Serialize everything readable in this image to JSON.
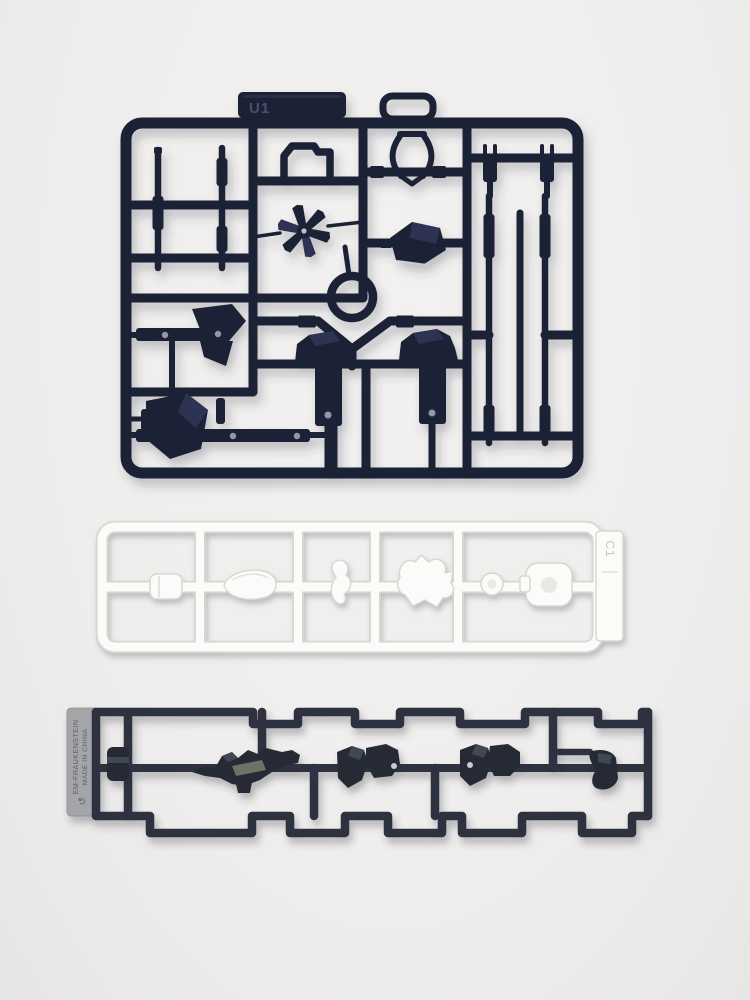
{
  "colors": {
    "background": "#f2f1f0",
    "sprue_black": "#1d2034",
    "sprue_black_facet": "#2e3252",
    "dot_light": "#a7adc0",
    "emboss_navy": "#4a4f72",
    "sprue_white": "#fbfbf9",
    "sprue_white_edge": "#d7d6d1",
    "sprue_white_hole": "#e9e8e4",
    "white_tab_text": "#c8c7c2",
    "sprue_charcoal": "#2e3240",
    "charcoal_part": "#262a36",
    "charcoal_facet": "#424757",
    "charcoal_panel": "#6d7268",
    "tab_gray": "#a4a5a9",
    "tab_gray_edge": "#8e8f93",
    "tab_text": "#5e6069"
  },
  "sprues": {
    "top_black": {
      "tab_label": "U1"
    },
    "middle_white": {
      "tab_label": "C1"
    },
    "bottom_charcoal": {
      "tab_line1": "EM-FRAUKENSTEIN",
      "tab_line2": "MADE IN CHINA"
    }
  },
  "icons": {
    "mold_symbol": "↺"
  }
}
